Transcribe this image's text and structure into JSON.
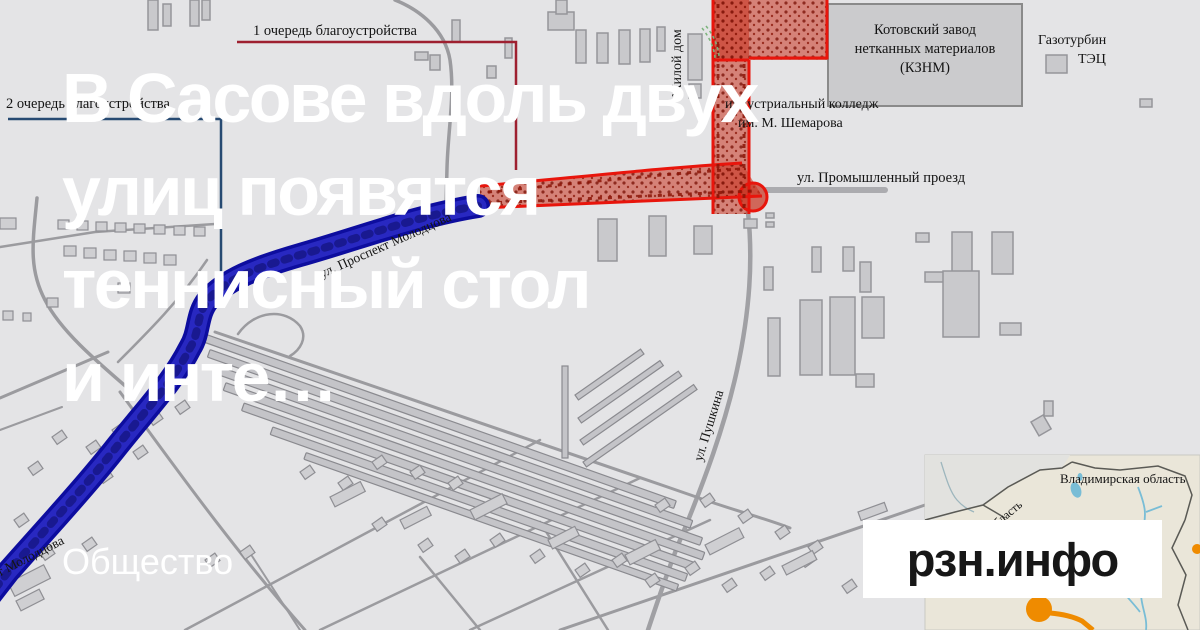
{
  "headline": {
    "lines": [
      "В Сасове вдоль двух",
      "улиц появятся",
      "теннисный стол",
      "и инте…"
    ],
    "category": "Общество"
  },
  "logo": {
    "text": "рзн.инфо"
  },
  "map_labels": {
    "phase1": "1 очередь благоустройства",
    "phase2": "2 очередь благоустройства",
    "residential": "Жилой дом",
    "factory_l1": "Котовский завод",
    "factory_l2": "нетканных материалов",
    "factory_l3": "(КЗНМ)",
    "power_l1": "Газотурбин",
    "power_l2": "ТЭЦ",
    "college_l1": "индустриальный колледж",
    "college_l2": "им. М. Шемарова",
    "street_prom": "ул. Промышленный проезд",
    "street_prospekt": "ул. Проспект Молодцова",
    "street_pushkina": "ул. Пушкина"
  },
  "inset_labels": {
    "vladimir": "Владимирская область",
    "oblast_fragment": "область"
  },
  "colors": {
    "background": "#e4e4e6",
    "building_fill": "#c9c9cc",
    "zone1_border_red": "#e8150c",
    "zone1_fill_red": "#c8321e",
    "zone2_road_blue": "#1515bd",
    "leader_red": "#9e2030",
    "leader_blue": "#274a72",
    "inset_land": "#eae6d9",
    "inset_orange": "#ef8b00",
    "inset_river": "#79bdd6",
    "headline_text": "#ffffff",
    "logo_text": "#171717",
    "logo_bg": "#ffffff"
  }
}
